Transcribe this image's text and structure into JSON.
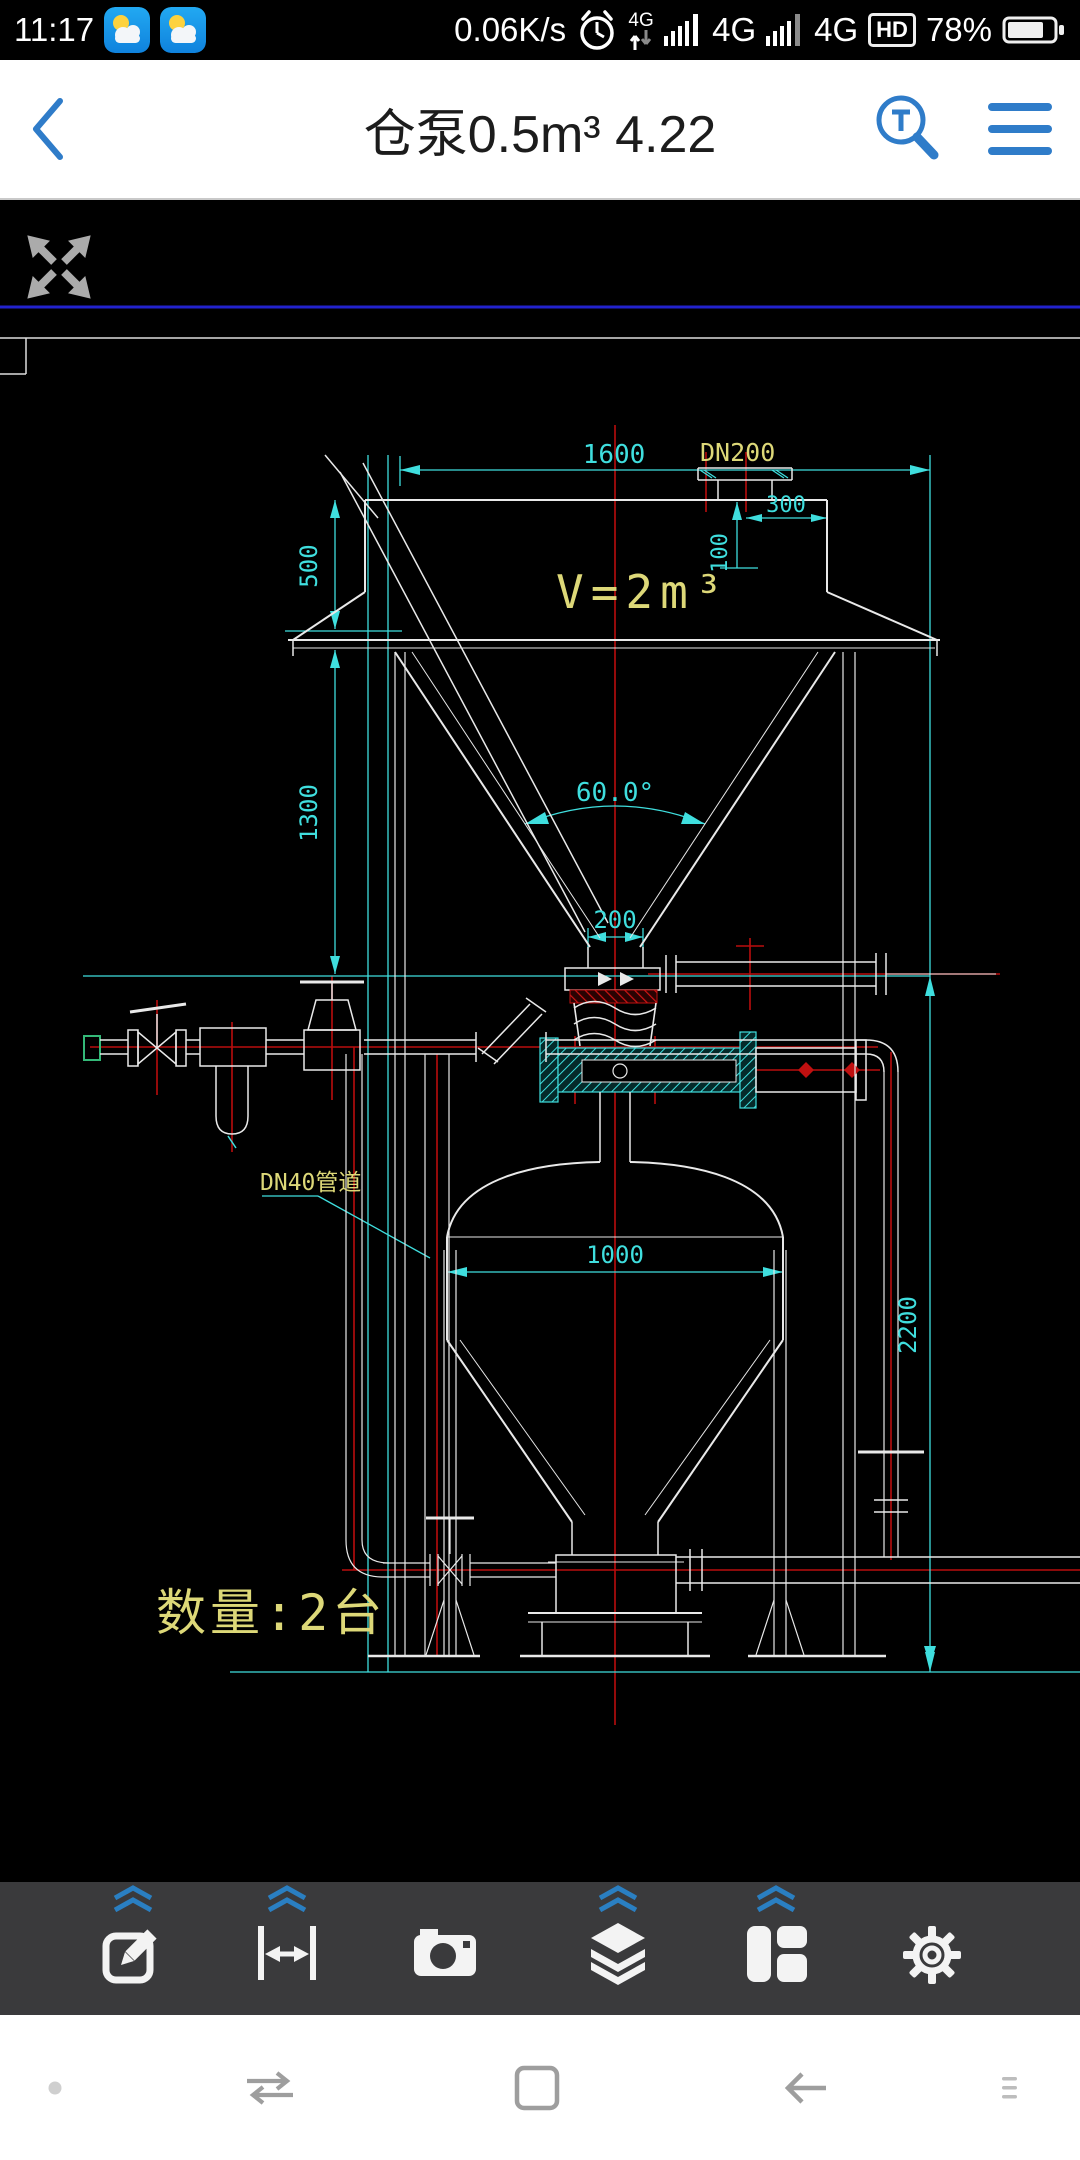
{
  "status_bar": {
    "time": "11:17",
    "net_speed": "0.06K/s",
    "data_net": "4G",
    "sig1_net": "4G",
    "sig2_net": "4G",
    "hd": "HD",
    "battery": "78%"
  },
  "title_bar": {
    "title": "仓泵0.5m³ 4.22"
  },
  "drawing": {
    "dim_1600": "1600",
    "nozzle_label": "DN200",
    "dim_300": "300",
    "dim_100": "100",
    "dim_500": "500",
    "dim_1300": "1300",
    "angle_label": "60.0°",
    "dim_200": "200",
    "volume_label": "V=2m³",
    "pipe_label": "DN40管道",
    "dim_1000": "1000",
    "dim_2200": "2200",
    "quantity_label": "数量:2台"
  },
  "toolbar": {
    "tools": [
      "edit",
      "measure",
      "camera",
      "layers",
      "layout",
      "settings"
    ]
  },
  "navbar": {
    "items": [
      "dot",
      "switch-apps",
      "recents",
      "back",
      "more"
    ]
  },
  "colors": {
    "accent_blue": "#2f7cc9",
    "cad_cyan": "#3fdede",
    "cad_yellow": "#ddd878",
    "cad_red": "#c01010",
    "toolbar_bg": "#3a3a3c"
  }
}
